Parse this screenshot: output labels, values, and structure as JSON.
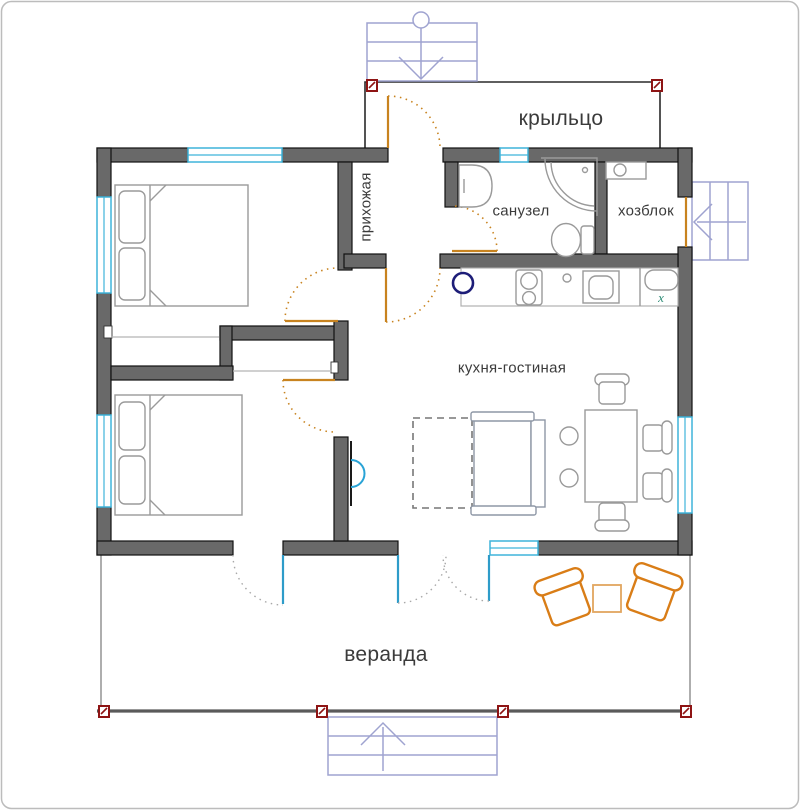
{
  "plan": {
    "type": "house floor plan",
    "width": 800,
    "height": 810
  },
  "rooms": {
    "porch": "крыльцо",
    "hallway": "прихожая",
    "bathroom": "санузел",
    "utility": "хозблок",
    "kitchen_living": "кухня-гостиная",
    "veranda": "веранда"
  },
  "kitchen": {
    "fridge_mark": "x"
  },
  "stairs": {
    "top_entry": {
      "steps": 3,
      "arrow_direction": "down"
    },
    "utility_entry": {
      "steps": 3,
      "arrow_direction": "left"
    },
    "veranda_entry": {
      "steps": 3,
      "arrow_direction": "up"
    }
  },
  "colors": {
    "wall": "#696969",
    "wall_stroke": "#111111",
    "window": "#3fb4da",
    "door": "#c8831f",
    "veranda_door": "#2e9cc9",
    "swing_arc_gray": "#a8a8a8",
    "stairs": "#9fa3d0",
    "post": "#8e1414",
    "furniture": "#9a9a9a",
    "sofa": "#8e97a6",
    "veranda_furniture": "#d97d17",
    "veranda_table": "#e2a65f",
    "accent_circle": "#1d1d78",
    "fridge_mark": "#2f8d77",
    "rod_line": "#b5b5b5",
    "tv": "#29a3d6",
    "text": "#3b3b3b",
    "border": "#bcbcbc"
  }
}
